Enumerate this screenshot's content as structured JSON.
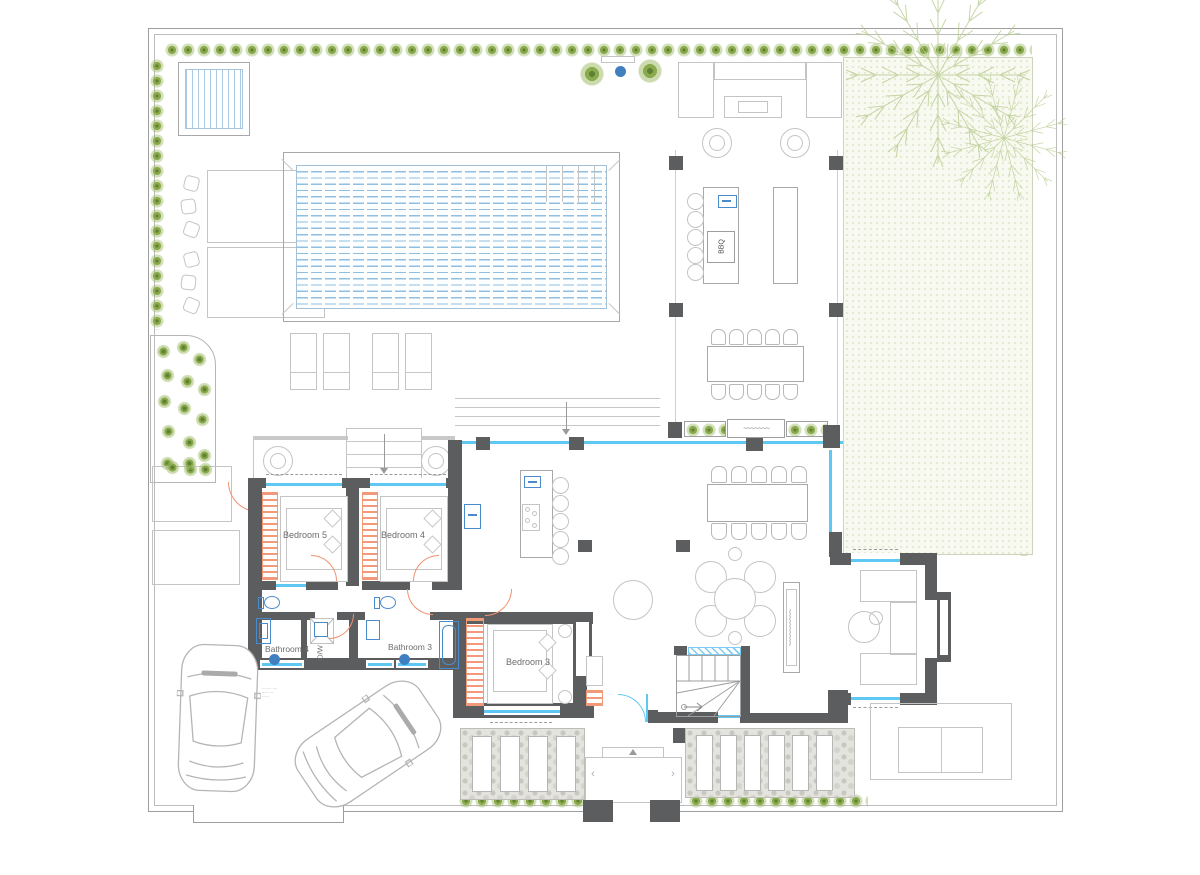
{
  "rooms": {
    "bedroom5": "Bedroom 5",
    "bedroom4": "Bedroom 4",
    "bedroom3": "Bedroom 3",
    "bathroom4": "Bathroom 4",
    "bathroom3": "Bathroom 3"
  },
  "equipment": {
    "bbq": "BBQ",
    "dw": "D/W"
  },
  "fireplace": {
    "squiggle_outdoor": "~~~~~~~",
    "squiggle_indoor": "~~~~~~~~~~"
  },
  "garage_note": {
    "line1": "-------- ----",
    "line2": "------ ---",
    "line3": "------"
  },
  "porch": {
    "chevron_left": "‹",
    "chevron_right": "›"
  },
  "colors": {
    "wall": "#5c5d5f",
    "glass_wall": "#5ec8f2",
    "door": "#f0926e",
    "plumbing_fixture": "#4a8ccb",
    "hedge_green": "#8aaa4e",
    "pool_water": "#8fc0e2",
    "lawn": "#f8f9f0"
  }
}
